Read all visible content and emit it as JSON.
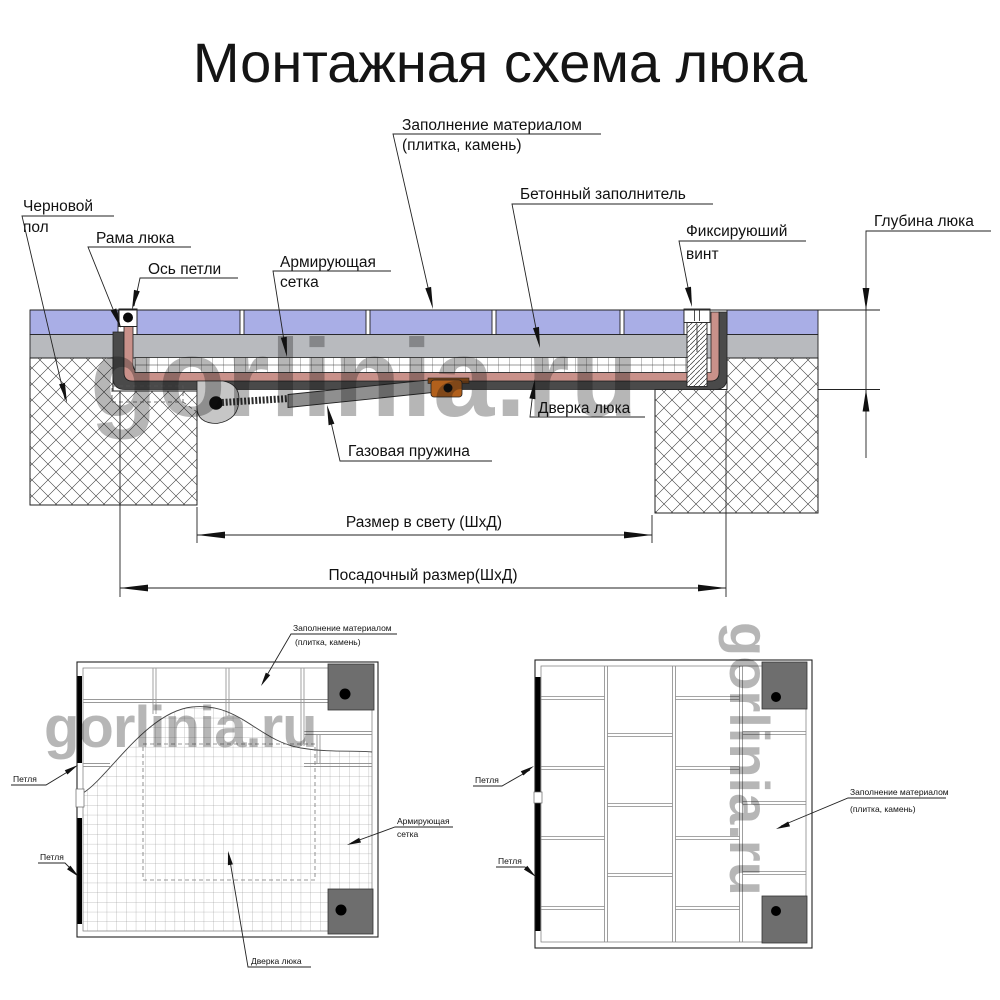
{
  "title": "Монтажная схема люка",
  "watermark": "gorlinia.ru",
  "colors": {
    "tile": "#a9aee6",
    "screed": "#b8babe",
    "frame_pink": "#c9918a",
    "door_dark": "#4a4a4a",
    "bracket_gray": "#c6c6c6",
    "bracket_plate": "#7a4418",
    "spring_gray": "#8f8f8f",
    "orange": "#b2601c",
    "plan_square": "#6e6e6e",
    "watermark_color": "#909090"
  },
  "section": {
    "labels": {
      "fill_material_line1": "Заполнение материалом",
      "fill_material_line2": "(плитка, камень)",
      "concrete_filler": "Бетонный заполнитель",
      "fixing_screw_line1": "Фиксируюший",
      "fixing_screw_line2": "винт",
      "hatch_depth": "Глубина люка",
      "rough_floor_line1": "Черновой",
      "rough_floor_line2": "пол",
      "hatch_frame": "Рама люка",
      "hinge_axis": "Ось петли",
      "reinforcing_mesh_line1": "Армирующая",
      "reinforcing_mesh_line2": "сетка",
      "hatch_door": "Дверка люка",
      "gas_spring": "Газовая пружина",
      "clear_size": "Размер в свету (ШхД)",
      "mounting_size": "Посадочный размер(ШхД)"
    }
  },
  "plan_left": {
    "labels": {
      "fill_line1": "Заполнение материалом",
      "fill_line2": "(плитка, камень)",
      "hinge_top": "Петля",
      "hinge_bottom": "Петля",
      "mesh_line1": "Армирующая",
      "mesh_line2": "сетка",
      "door": "Дверка люка"
    }
  },
  "plan_right": {
    "labels": {
      "hinge_top": "Петля",
      "hinge_bottom": "Петля",
      "fill_line1": "Заполнение материалом",
      "fill_line2": "(плитка, камень)"
    }
  }
}
